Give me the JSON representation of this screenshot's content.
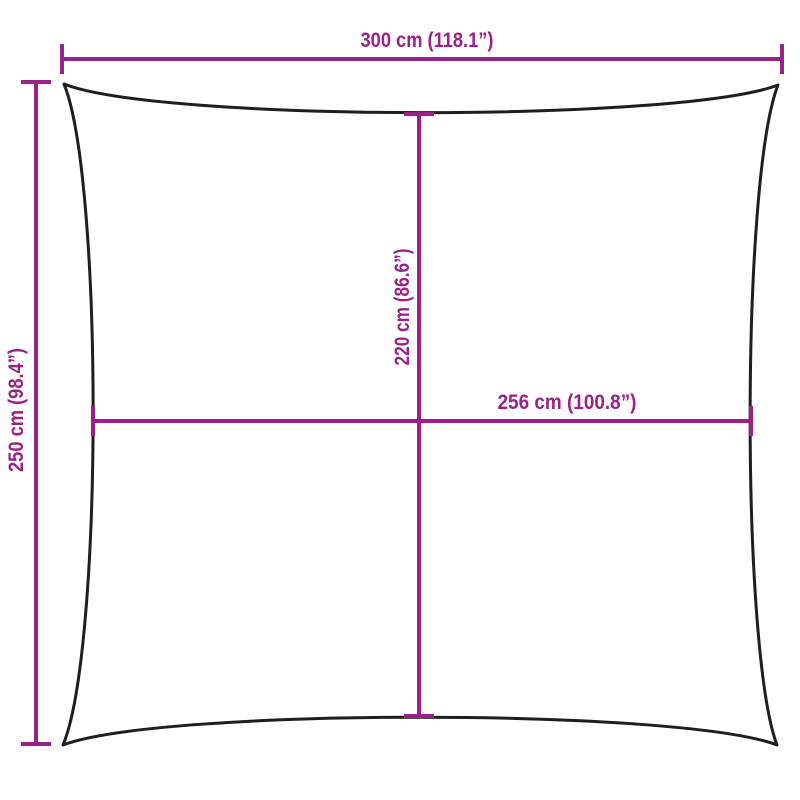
{
  "colors": {
    "accent": "#9B2188",
    "outline": "#1E1E1C",
    "background": "#FFFFFF"
  },
  "dimensions": {
    "top_width": {
      "label": "300 cm (118.1”)",
      "cm": 300,
      "in": 118.1
    },
    "left_height": {
      "label": "250 cm (98.4”)",
      "cm": 250,
      "in": 98.4
    },
    "center_height": {
      "label": "220 cm (86.6”)",
      "cm": 220,
      "in": 86.6
    },
    "center_width": {
      "label": "256 cm (100.8”)",
      "cm": 256,
      "in": 100.8
    }
  }
}
